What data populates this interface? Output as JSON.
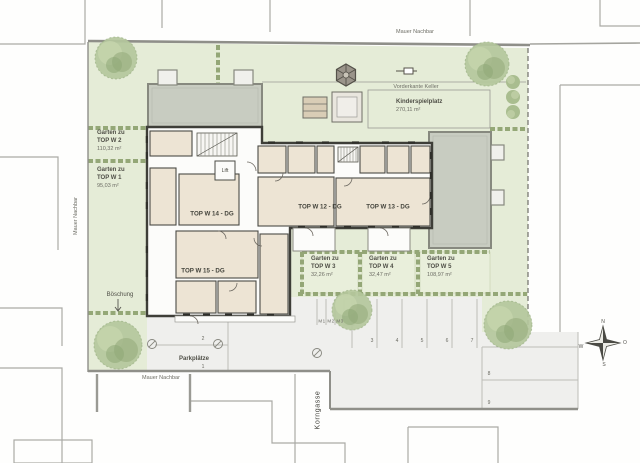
{
  "plan": {
    "boundaries": {
      "wall_top": "Mauer Nachbar",
      "wall_left": "Mauer Nachbar",
      "wall_bottom": "Mauer Nachbar"
    },
    "street": {
      "name": "Korngasse"
    },
    "annotations": {
      "basement_edge": "Vorderkante Keller",
      "slope": "Böschung",
      "moto_stalls": "M1 M2 M3"
    },
    "playground": {
      "name": "Kinderspielplatz",
      "area": "270,11 m²"
    },
    "units": {
      "w12": {
        "label": "TOP W 12 - DG"
      },
      "w13": {
        "label": "TOP W 13 - DG"
      },
      "w14": {
        "label": "TOP W 14 - DG"
      },
      "w15": {
        "label": "TOP W 15 - DG"
      },
      "lift": {
        "label": "Lift"
      }
    },
    "gardens": [
      {
        "prefix": "Garten zu",
        "name": "TOP W 2",
        "area": "110,32 m²"
      },
      {
        "prefix": "Garten zu",
        "name": "TOP W 1",
        "area": "95,03 m²"
      },
      {
        "prefix": "Garten zu",
        "name": "TOP W 3",
        "area": "32,26 m²"
      },
      {
        "prefix": "Garten zu",
        "name": "TOP W 4",
        "area": "32,47 m²"
      },
      {
        "prefix": "Garten zu",
        "name": "TOP W 5",
        "area": "108,97 m²"
      }
    ],
    "parking": {
      "title": "Parkplätze",
      "stalls": [
        "1",
        "2",
        "3",
        "4",
        "5",
        "6",
        "7",
        "8",
        "9"
      ]
    },
    "compass": {
      "north": "N",
      "east": "O",
      "south": "S",
      "west": "W"
    },
    "colors": {
      "site_green": "#e5ecd7",
      "hedge_green": "#90a472",
      "room_beige": "#ede4d4",
      "roof_gray": "#c8ccc1",
      "paving_gray": "#efefed",
      "wall_dark": "#3e3e38"
    }
  }
}
